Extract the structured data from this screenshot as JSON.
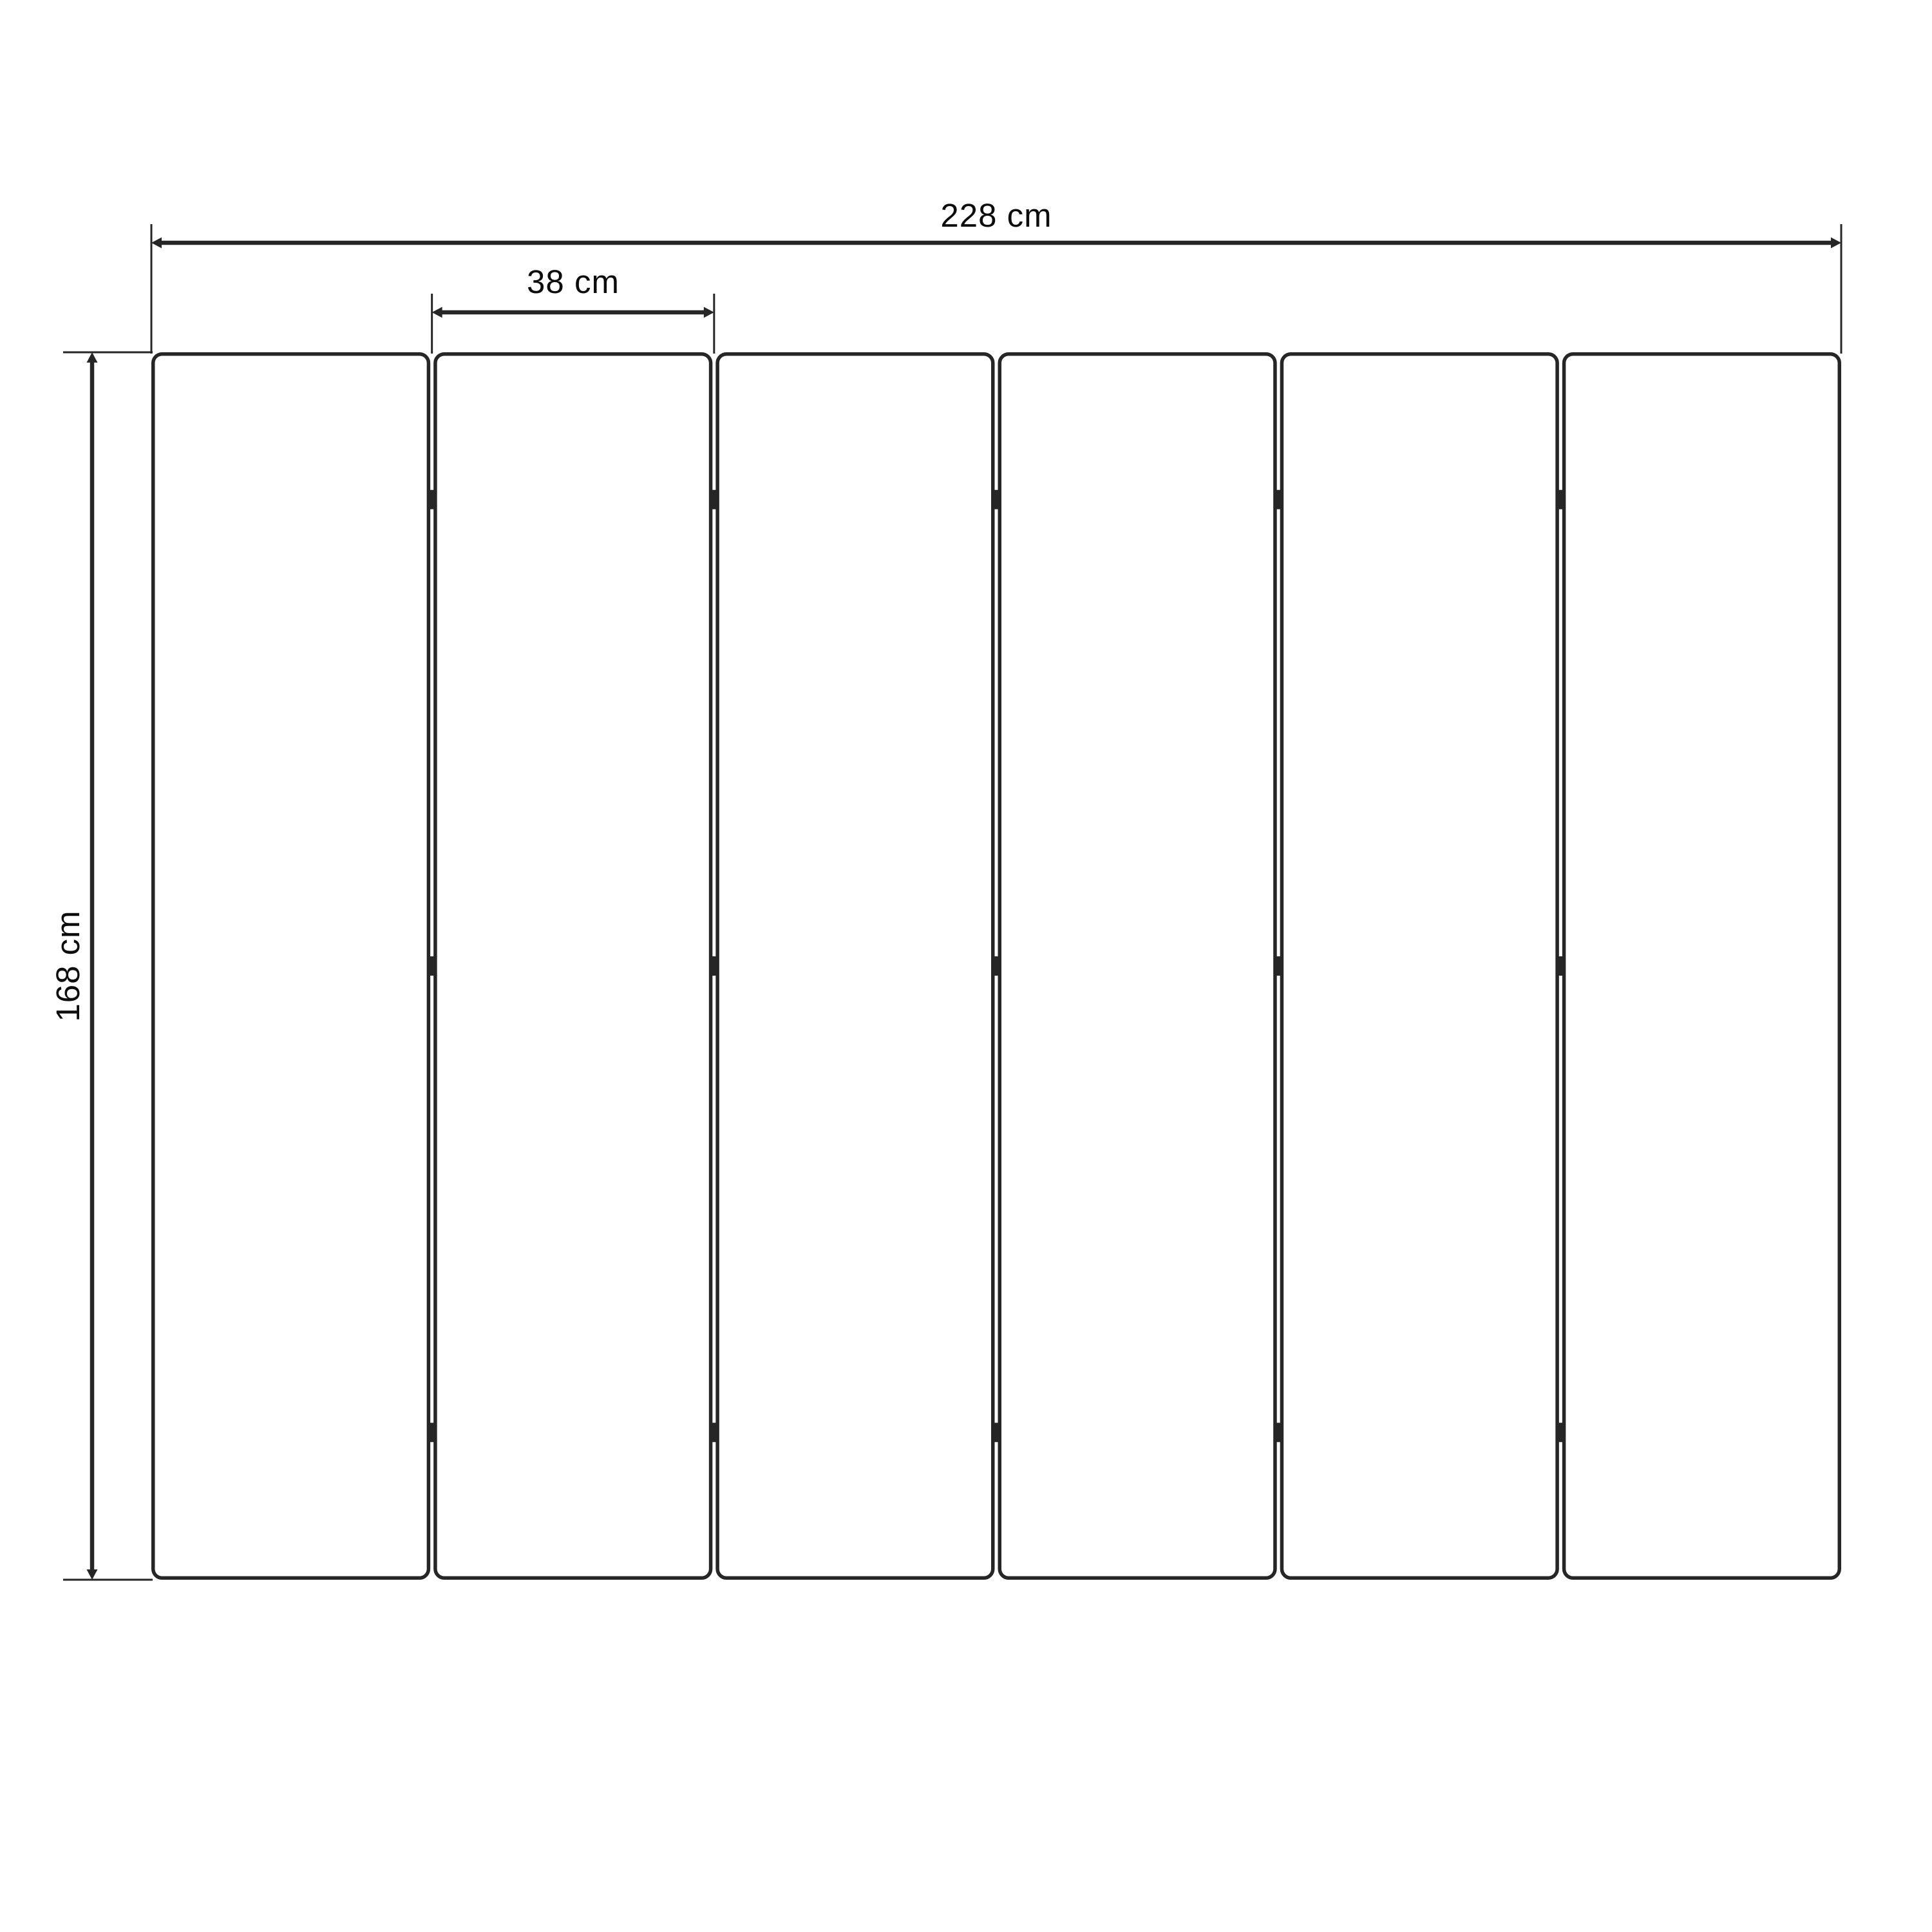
{
  "page": {
    "background_color": "#ffffff"
  },
  "diagram": {
    "type": "dimensioned-technical-drawing",
    "subject": "six-panel folding screen, front elevation",
    "stroke_color": "#262626",
    "text_color": "#0c0c0c",
    "panel_fill": "#ffffff",
    "panels": {
      "count": 6,
      "joint_count": 5,
      "hinges_per_joint": 3
    },
    "dimensions": {
      "total_width": {
        "label": "228 cm",
        "value": 228,
        "unit": "cm"
      },
      "single_panel_width": {
        "label": "38 cm",
        "value": 38,
        "unit": "cm"
      },
      "height": {
        "label": "168 cm",
        "value": 168,
        "unit": "cm"
      }
    }
  }
}
